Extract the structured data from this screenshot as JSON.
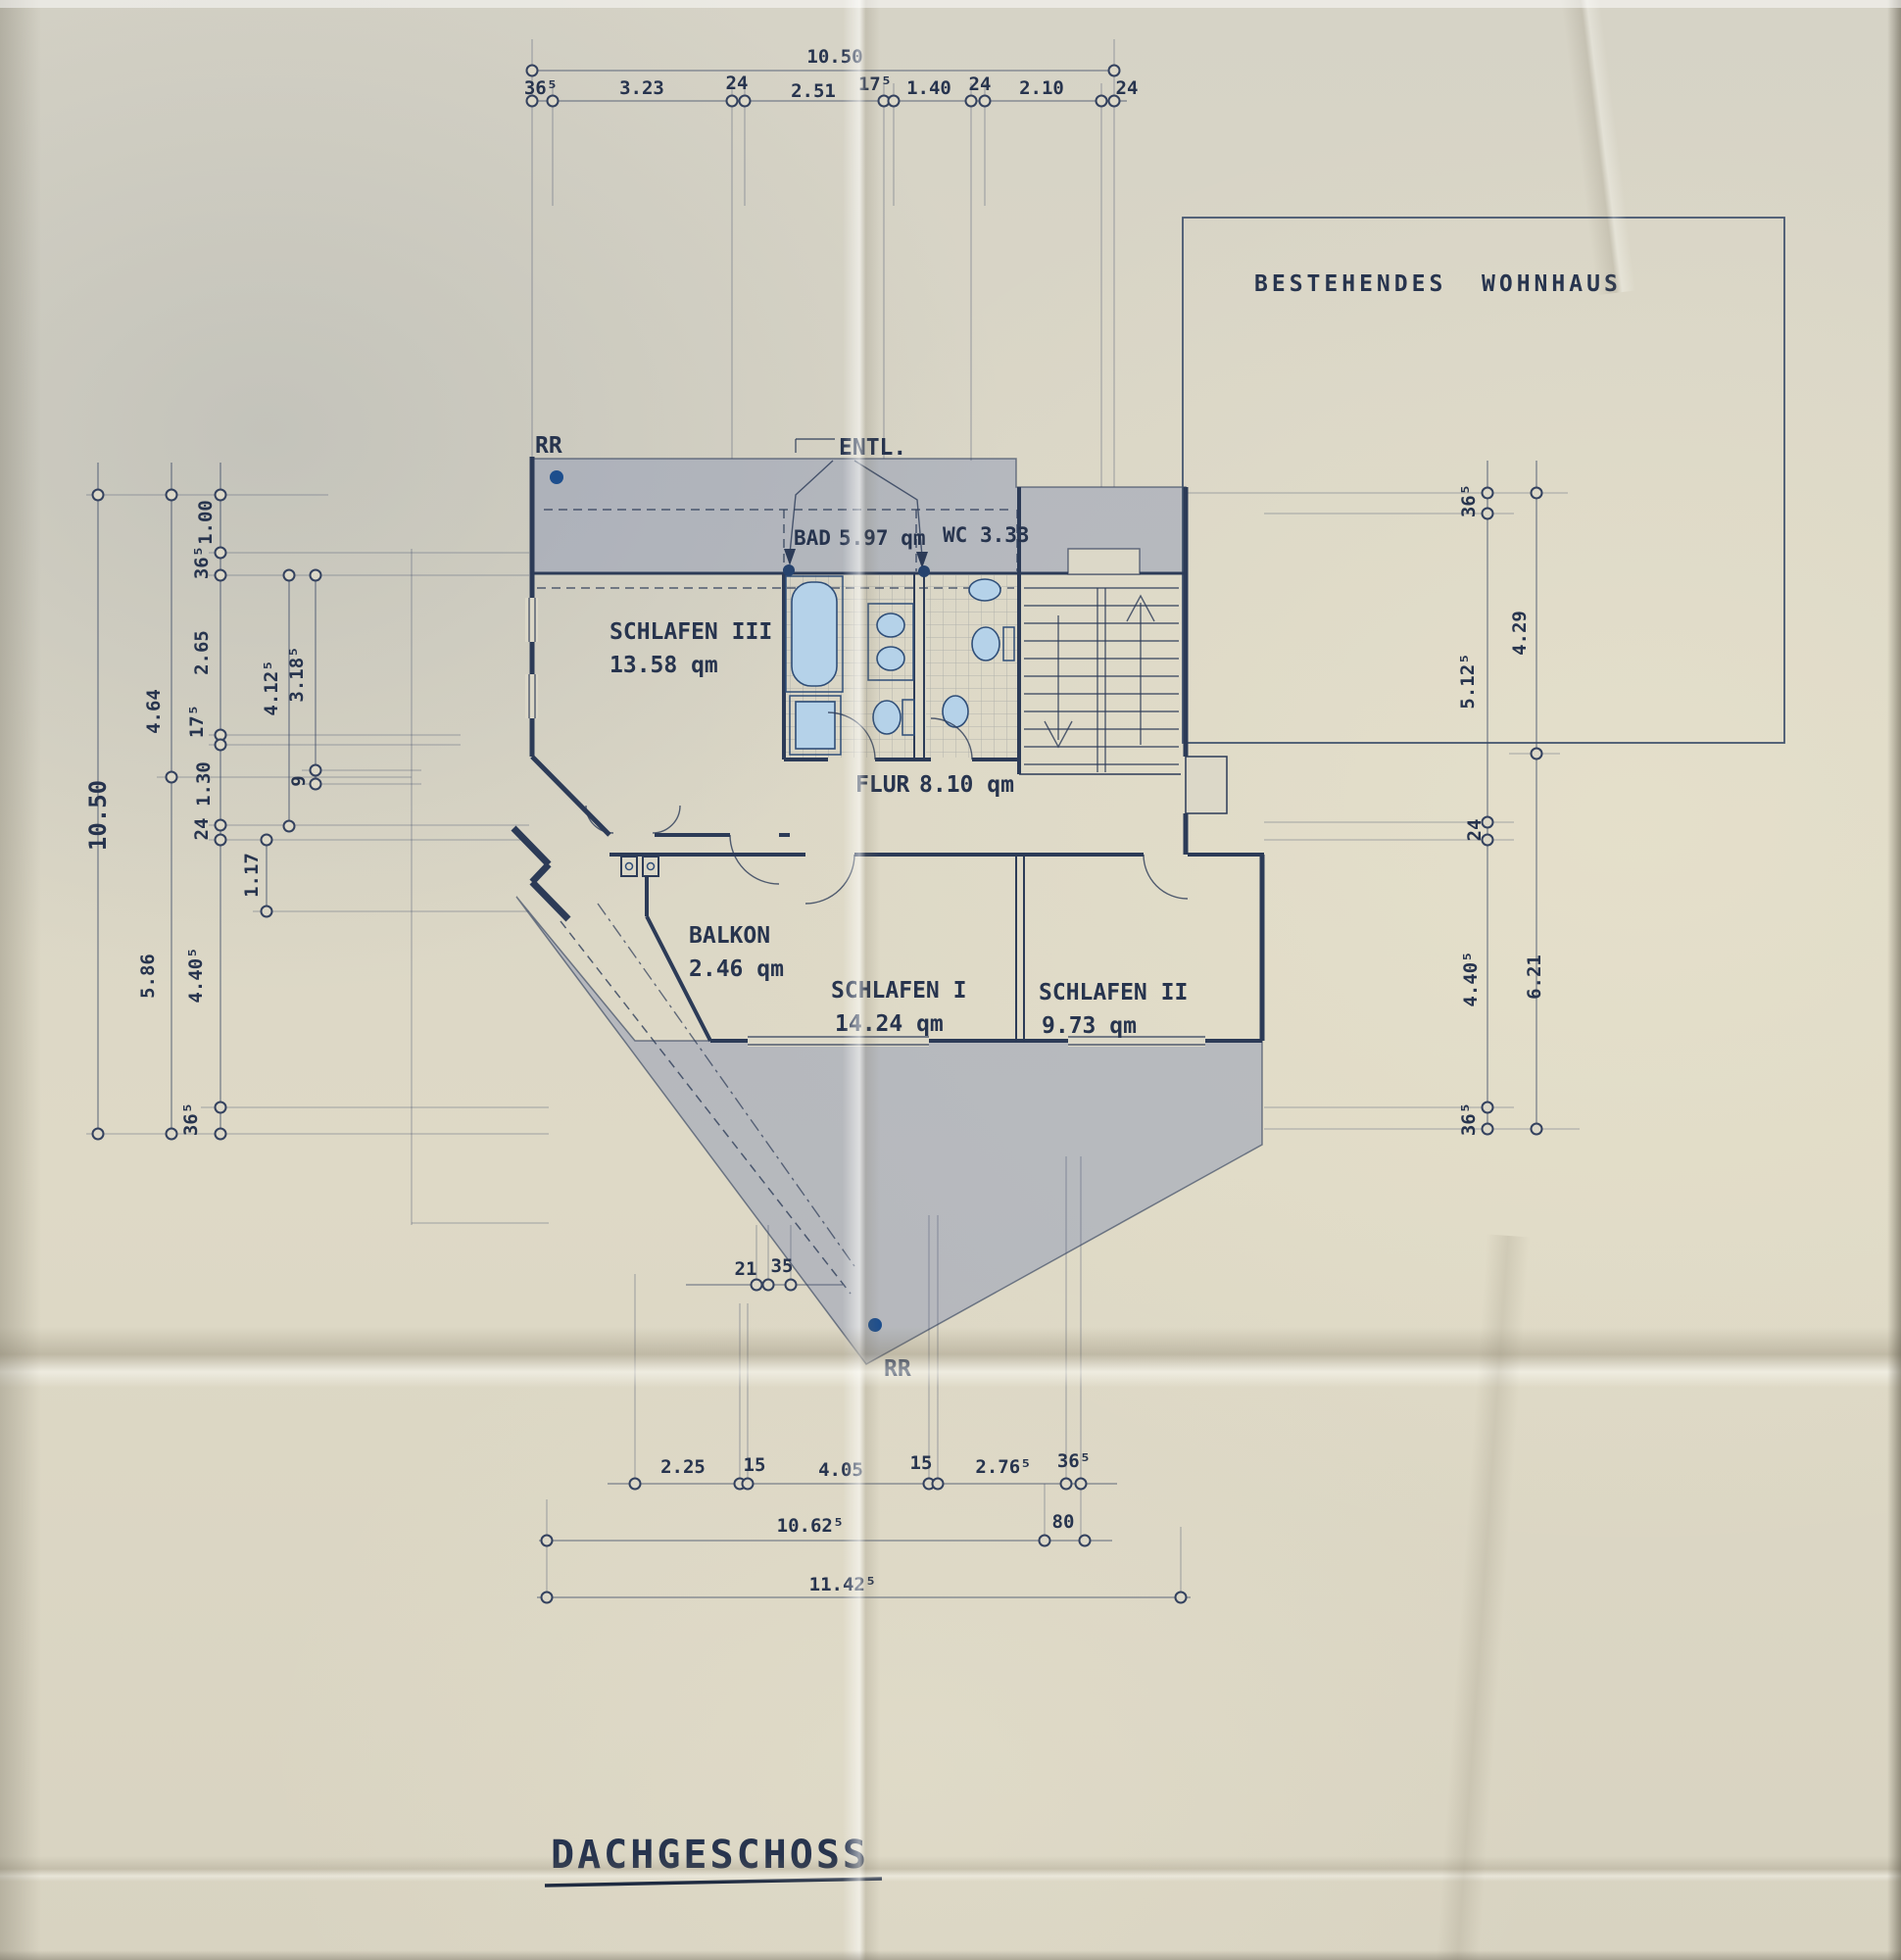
{
  "document": {
    "title": "DACHGESCHOSS"
  },
  "labels": {
    "existing_house": "BESTEHENDES  WOHNHAUS",
    "rr_top": "RR",
    "rr_bottom": "RR",
    "vent": "ENTL."
  },
  "rooms": {
    "schlafen3": {
      "name": "SCHLAFEN III",
      "area": "13.58 qm"
    },
    "bad": {
      "name": "BAD",
      "area": "5.97 qm"
    },
    "wc": {
      "name": "WC",
      "area": "3.33"
    },
    "flur": {
      "name": "FLUR",
      "area": "8.10 qm"
    },
    "balkon": {
      "name": "BALKON",
      "area": "2.46 qm"
    },
    "schlafen1": {
      "name": "SCHLAFEN I",
      "area": "14.24 qm"
    },
    "schlafen2": {
      "name": "SCHLAFEN II",
      "area": "9.73 qm"
    }
  },
  "dims": {
    "top_total": "10.50",
    "top": [
      "36⁵",
      "3.23",
      "24",
      "2.51",
      "17⁵",
      "1.40",
      "24",
      "2.10",
      "24"
    ],
    "left_total": "10.50",
    "left_outer": [
      "4.64",
      "5.86"
    ],
    "left_inner": [
      "1.00",
      "36⁵",
      "2.65",
      "17⁵",
      "1.30",
      "24",
      "4.40⁵",
      "36⁵"
    ],
    "left_aux": [
      "4.12⁵",
      "3.18⁵",
      "9",
      "1.17"
    ],
    "right_inner": [
      "36⁵",
      "5.12⁵",
      "24",
      "4.40⁵",
      "36⁵"
    ],
    "right_outer": [
      "4.29",
      "6.21"
    ],
    "roof": [
      "21",
      "35"
    ],
    "bottom": [
      "2.25",
      "15",
      "4.05",
      "15",
      "2.76⁵",
      "36⁵"
    ],
    "bottom_mid": [
      "10.62⁵",
      "80"
    ],
    "bottom_total": "11.42⁵"
  }
}
